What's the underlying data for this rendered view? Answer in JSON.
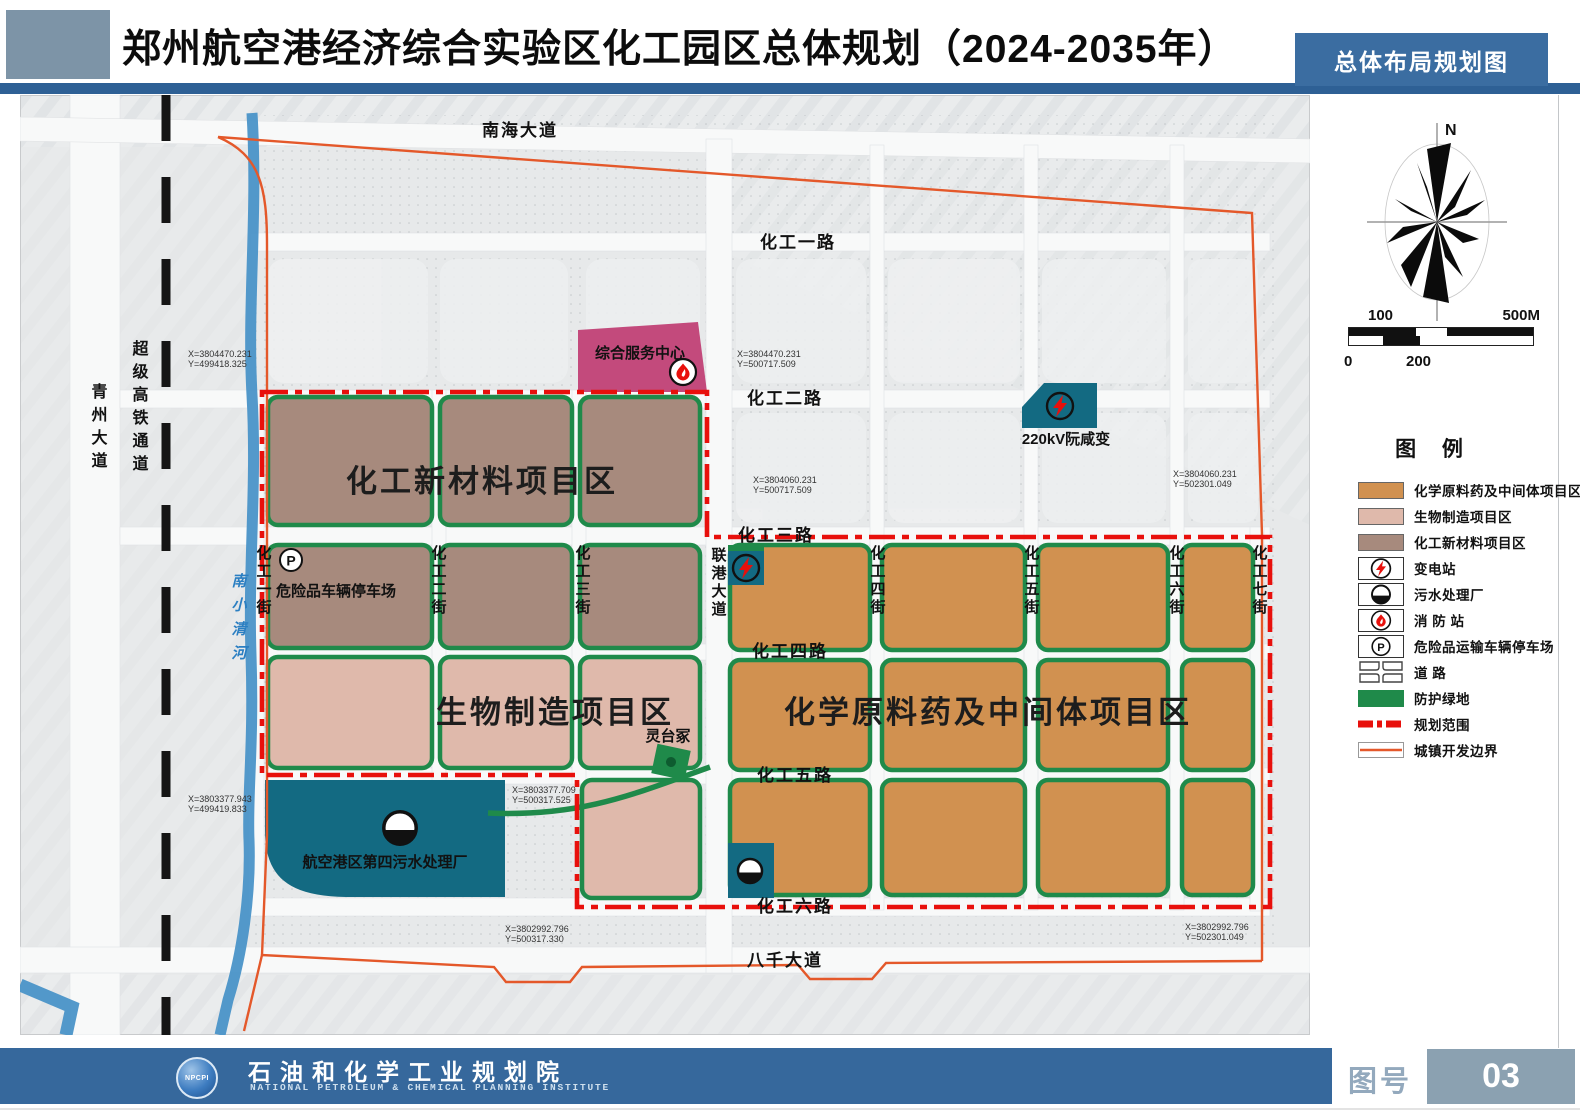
{
  "header": {
    "title": "郑州航空港经济综合实验区化工园区总体规划（2024-2035年）",
    "tag": "总体布局规划图"
  },
  "compass": {
    "north": "N"
  },
  "scalebar": {
    "label_100": "100",
    "label_500m": "500M",
    "label_0": "0",
    "label_200": "200"
  },
  "legend": {
    "title": "图  例",
    "items": [
      {
        "label": "化学原料药及中间体项目区",
        "type": "swatch",
        "color": "#d19150"
      },
      {
        "label": "生物制造项目区",
        "type": "swatch",
        "color": "#dfb9ab"
      },
      {
        "label": "化工新材料项目区",
        "type": "swatch",
        "color": "#a78a7d"
      },
      {
        "label": "变电站",
        "type": "icon",
        "icon": "lightning-icon"
      },
      {
        "label": "污水处理厂",
        "type": "icon",
        "icon": "sewage-icon"
      },
      {
        "label": "消 防 站",
        "type": "icon",
        "icon": "flame-icon"
      },
      {
        "label": "危险品运输车辆停车场",
        "type": "icon",
        "icon": "parking-icon"
      },
      {
        "label": "道 路",
        "type": "icon",
        "icon": "road-icon"
      },
      {
        "label": "防护绿地",
        "type": "swatch",
        "color": "#1f8a4a"
      },
      {
        "label": "规划范围",
        "type": "line",
        "color": "#e8100c"
      },
      {
        "label": "城镇开发边界",
        "type": "line",
        "color": "#e4582a"
      }
    ]
  },
  "map": {
    "roads": {
      "nanhai": "南海大道",
      "hg1": "化工一路",
      "hg2": "化工二路",
      "hg3": "化工三路",
      "hg4": "化工四路",
      "hg5": "化工五路",
      "hg6": "化工六路",
      "baqian": "八千大道",
      "qingzhou": "青州大道",
      "rail": "超级高铁通道",
      "s1": "化工一街",
      "s2": "化工二街",
      "s3": "化工三街",
      "liangang": "联港大道",
      "s4": "化工四街",
      "s5": "化工五街",
      "s6": "化工六街",
      "s7": "化工七街"
    },
    "river": "南小清河",
    "zones": {
      "new_materials": "化工新材料项目区",
      "bio": "生物制造项目区",
      "api": "化学原料药及中间体项目区"
    },
    "sites": {
      "service_center": "综合服务中心",
      "substation": "220kV阮咸变",
      "parking": "危险品车辆停车场",
      "sewage_plant": "航空港区第四污水处理厂",
      "tomb": "灵台冢"
    },
    "parking_glyph": "P",
    "coords": [
      {
        "x": "X=3804470.231",
        "y": "Y=499418.325"
      },
      {
        "x": "X=3804470.231",
        "y": "Y=500717.509"
      },
      {
        "x": "X=3804060.231",
        "y": "Y=500717.509"
      },
      {
        "x": "X=3804060.231",
        "y": "Y=502301.049"
      },
      {
        "x": "X=3803377.943",
        "y": "Y=499419.833"
      },
      {
        "x": "X=3803377.709",
        "y": "Y=500317.525"
      },
      {
        "x": "X=3802992.796",
        "y": "Y=500317.330"
      },
      {
        "x": "X=3802992.796",
        "y": "Y=502301.049"
      }
    ]
  },
  "footer": {
    "logo": "NPCPI",
    "org_cn": "石油和化学工业规划院",
    "org_en": "NATIONAL PETROLEUM & CHEMICAL PLANNING INSTITUTE",
    "sheet_label": "图号",
    "sheet_no": "03"
  },
  "colors": {
    "header_blue": "#36689c",
    "strip_blue": "#2e6095",
    "header_block_gray": "#7d94a7",
    "sheet_box_gray": "#8ba1b1",
    "orange_zone": "#d19150",
    "pink_zone": "#dfb9ab",
    "mauve_zone": "#a78a7d",
    "teal_facility": "#136a82",
    "magenta_service": "#c34a7c",
    "green_buffer": "#1f8a4a",
    "red_boundary": "#e8100c",
    "orange_boundary": "#e4582a",
    "river_blue": "#4a94c8"
  }
}
